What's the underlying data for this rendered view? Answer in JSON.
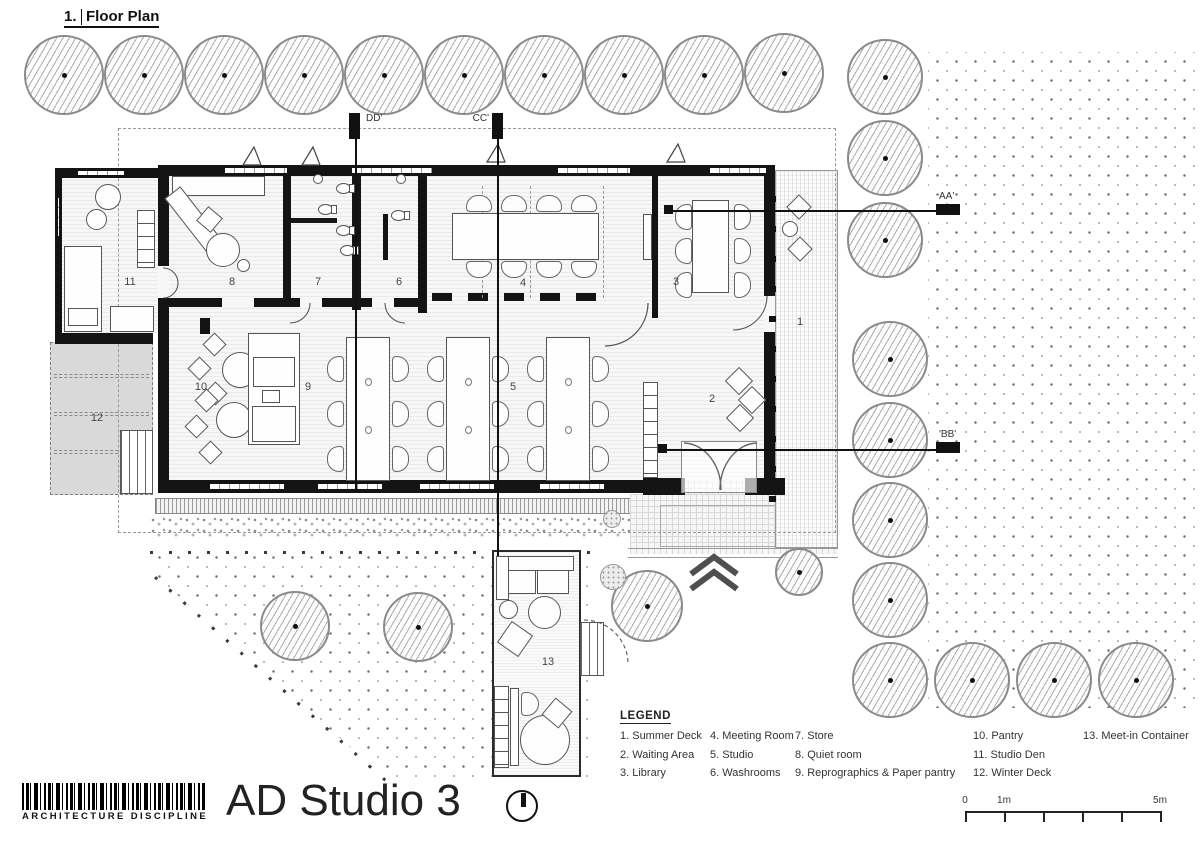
{
  "title_block": {
    "drawing_number": "1.",
    "drawing_title": "Floor Plan",
    "project_title": "AD Studio 3",
    "firm_name": "ARCHITECTURE DISCIPLINE"
  },
  "legend": {
    "title": "LEGEND",
    "columns": [
      [
        "1. Summer Deck",
        "2. Waiting Area",
        "3. Library"
      ],
      [
        "4. Meeting Room",
        "5. Studio",
        "6. Washrooms"
      ],
      [
        "7. Store",
        "8. Quiet room",
        "9. Reprographics & Paper pantry"
      ],
      [
        "10. Pantry",
        "11. Studio Den",
        "12. Winter Deck"
      ],
      [
        "13. Meet-in Container"
      ]
    ]
  },
  "rooms": [
    {
      "n": "1",
      "x": 800,
      "y": 322
    },
    {
      "n": "2",
      "x": 712,
      "y": 399
    },
    {
      "n": "3",
      "x": 676,
      "y": 282
    },
    {
      "n": "4",
      "x": 523,
      "y": 283
    },
    {
      "n": "5",
      "x": 513,
      "y": 387
    },
    {
      "n": "6",
      "x": 399,
      "y": 282
    },
    {
      "n": "7",
      "x": 318,
      "y": 282
    },
    {
      "n": "8",
      "x": 232,
      "y": 282
    },
    {
      "n": "9",
      "x": 308,
      "y": 387
    },
    {
      "n": "10",
      "x": 201,
      "y": 387
    },
    {
      "n": "11",
      "x": 130,
      "y": 282
    },
    {
      "n": "12",
      "x": 97,
      "y": 418
    },
    {
      "n": "13",
      "x": 548,
      "y": 662
    }
  ],
  "sections": [
    {
      "label": "DD'"
    },
    {
      "label": "CC'"
    },
    {
      "label": "AA'"
    },
    {
      "label": "'BB'"
    }
  ],
  "scale_bar": {
    "labels": [
      {
        "text": "0",
        "x": 0
      },
      {
        "text": "1m",
        "x": 39
      },
      {
        "text": "5m",
        "x": 195
      }
    ],
    "ticks": [
      0,
      39,
      78,
      117,
      156,
      195
    ]
  },
  "icons": {
    "north_arrow": "north-arrow-icon",
    "tree": "tree-icon",
    "entry_chevrons": "chevron-up-icon",
    "barcode": "barcode-logo"
  },
  "colors": {
    "wall": "#141414",
    "winter_deck_fill": "#d9d9d9",
    "tree_hatch": "#ababab",
    "dot_grid": "#6f6f6f",
    "annotation_line": "#555555"
  }
}
